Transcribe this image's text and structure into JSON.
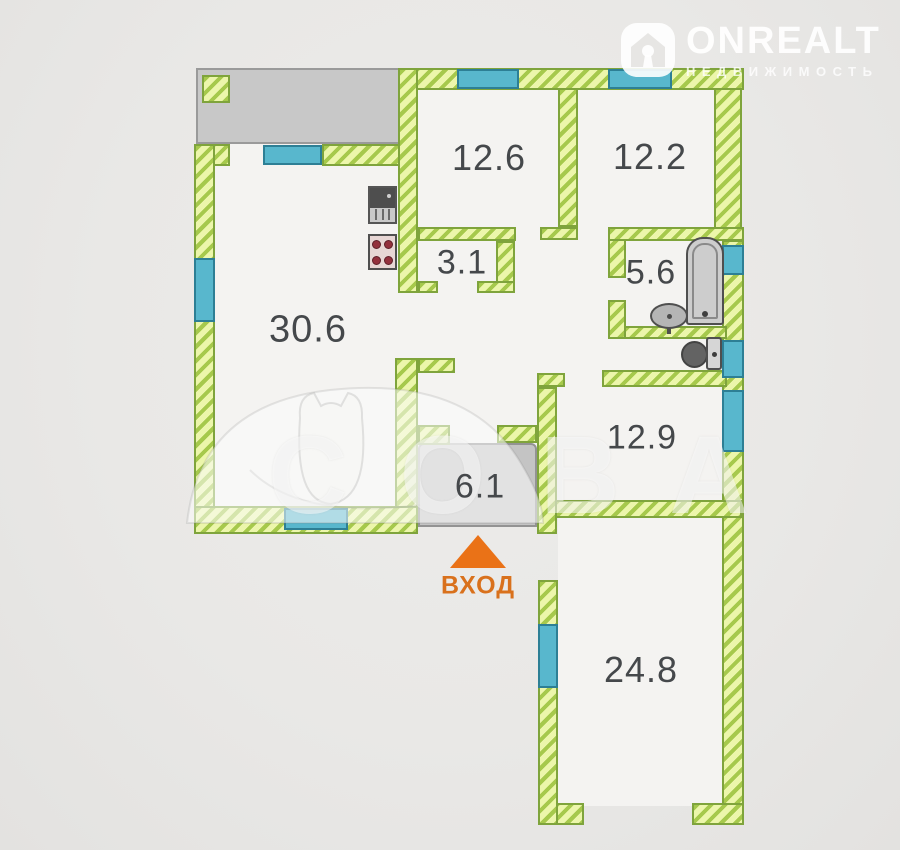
{
  "colors": {
    "background": "#e9e8e6",
    "floor": "#f4f3f1",
    "wall_fill": "#ecf6ab",
    "wall_stripe": "#a6c94c",
    "wall_border": "#7fa43c",
    "window_fill": "#58b7cd",
    "window_border": "#2d7f95",
    "gray_zone_fill": "#c8c8c8",
    "label_text": "#45484b",
    "entrance_orange": "#ea7217"
  },
  "logo": {
    "icon": "house-icon",
    "brand": "ONREALT",
    "subtitle": "НЕДВИЖИМОСТЬ"
  },
  "entrance": {
    "label": "ВХОД",
    "arrow": "up-triangle-icon"
  },
  "watermark": {
    "text": "СОВА",
    "sketch": "owl-sketch"
  },
  "fixtures": [
    "kitchen-sink",
    "stove",
    "bathtub",
    "wash-basin",
    "toilet"
  ],
  "rooms": [
    {
      "name": "living-room",
      "area": "30.6",
      "cx": 308,
      "cy": 330,
      "fs": 38
    },
    {
      "name": "bedroom-1",
      "area": "12.6",
      "cx": 489,
      "cy": 158,
      "fs": 36
    },
    {
      "name": "bedroom-2",
      "area": "12.2",
      "cx": 650,
      "cy": 157,
      "fs": 36
    },
    {
      "name": "corridor",
      "area": "3.1",
      "cx": 462,
      "cy": 263,
      "fs": 34
    },
    {
      "name": "bathroom",
      "area": "5.6",
      "cx": 651,
      "cy": 273,
      "fs": 34
    },
    {
      "name": "hallway",
      "area": "12.9",
      "cx": 642,
      "cy": 438,
      "fs": 34
    },
    {
      "name": "entry-hall",
      "area": "6.1",
      "cx": 480,
      "cy": 487,
      "fs": 34
    },
    {
      "name": "big-room",
      "area": "24.8",
      "cx": 641,
      "cy": 670,
      "fs": 36
    }
  ],
  "plan": {
    "floors": [
      {
        "x": 213,
        "y": 86,
        "w": 510,
        "h": 422
      },
      {
        "x": 558,
        "y": 516,
        "w": 166,
        "h": 290
      }
    ],
    "gray_zones": [
      {
        "name": "balcony",
        "cls": "",
        "x": 196,
        "y": 68,
        "w": 204,
        "h": 76
      },
      {
        "name": "entry-hall-zone",
        "cls": "hall",
        "x": 418,
        "y": 443,
        "w": 119,
        "h": 84
      }
    ],
    "pillars": [
      {
        "x": 202,
        "y": 75,
        "w": 28,
        "h": 28
      }
    ],
    "walls": [
      {
        "x": 398,
        "y": 68,
        "w": 346,
        "h": 22
      },
      {
        "x": 714,
        "y": 88,
        "w": 28,
        "h": 152
      },
      {
        "x": 722,
        "y": 240,
        "w": 22,
        "h": 262
      },
      {
        "x": 722,
        "y": 500,
        "w": 22,
        "h": 325
      },
      {
        "x": 692,
        "y": 803,
        "w": 52,
        "h": 22
      },
      {
        "x": 538,
        "y": 803,
        "w": 46,
        "h": 22
      },
      {
        "x": 538,
        "y": 580,
        "w": 20,
        "h": 245
      },
      {
        "x": 538,
        "y": 500,
        "w": 204,
        "h": 18
      },
      {
        "x": 537,
        "y": 387,
        "w": 20,
        "h": 147
      },
      {
        "x": 537,
        "y": 373,
        "w": 28,
        "h": 14
      },
      {
        "x": 602,
        "y": 370,
        "w": 125,
        "h": 17
      },
      {
        "x": 608,
        "y": 326,
        "w": 119,
        "h": 13
      },
      {
        "x": 608,
        "y": 300,
        "w": 18,
        "h": 39
      },
      {
        "x": 608,
        "y": 228,
        "w": 18,
        "h": 50
      },
      {
        "x": 608,
        "y": 227,
        "w": 136,
        "h": 14
      },
      {
        "x": 558,
        "y": 88,
        "w": 20,
        "h": 139
      },
      {
        "x": 540,
        "y": 227,
        "w": 38,
        "h": 13
      },
      {
        "x": 418,
        "y": 227,
        "w": 98,
        "h": 14
      },
      {
        "x": 496,
        "y": 241,
        "w": 19,
        "h": 52
      },
      {
        "x": 477,
        "y": 281,
        "w": 38,
        "h": 12
      },
      {
        "x": 398,
        "y": 68,
        "w": 20,
        "h": 225
      },
      {
        "x": 418,
        "y": 281,
        "w": 20,
        "h": 12
      },
      {
        "x": 395,
        "y": 358,
        "w": 23,
        "h": 176
      },
      {
        "x": 418,
        "y": 358,
        "w": 37,
        "h": 15
      },
      {
        "x": 418,
        "y": 425,
        "w": 32,
        "h": 20
      },
      {
        "x": 497,
        "y": 425,
        "w": 40,
        "h": 18
      },
      {
        "x": 194,
        "y": 144,
        "w": 36,
        "h": 22
      },
      {
        "x": 322,
        "y": 144,
        "w": 78,
        "h": 22
      },
      {
        "x": 194,
        "y": 144,
        "w": 21,
        "h": 390
      },
      {
        "x": 194,
        "y": 506,
        "w": 224,
        "h": 28
      }
    ],
    "windows": [
      {
        "x": 457,
        "y": 69,
        "w": 62,
        "h": 20
      },
      {
        "x": 608,
        "y": 69,
        "w": 64,
        "h": 20
      },
      {
        "x": 263,
        "y": 145,
        "w": 59,
        "h": 20
      },
      {
        "x": 194,
        "y": 258,
        "w": 21,
        "h": 64
      },
      {
        "x": 284,
        "y": 508,
        "w": 64,
        "h": 22
      },
      {
        "x": 722,
        "y": 245,
        "w": 22,
        "h": 30
      },
      {
        "x": 722,
        "y": 340,
        "w": 22,
        "h": 38
      },
      {
        "x": 722,
        "y": 390,
        "w": 22,
        "h": 62
      },
      {
        "x": 538,
        "y": 624,
        "w": 20,
        "h": 64
      }
    ]
  }
}
